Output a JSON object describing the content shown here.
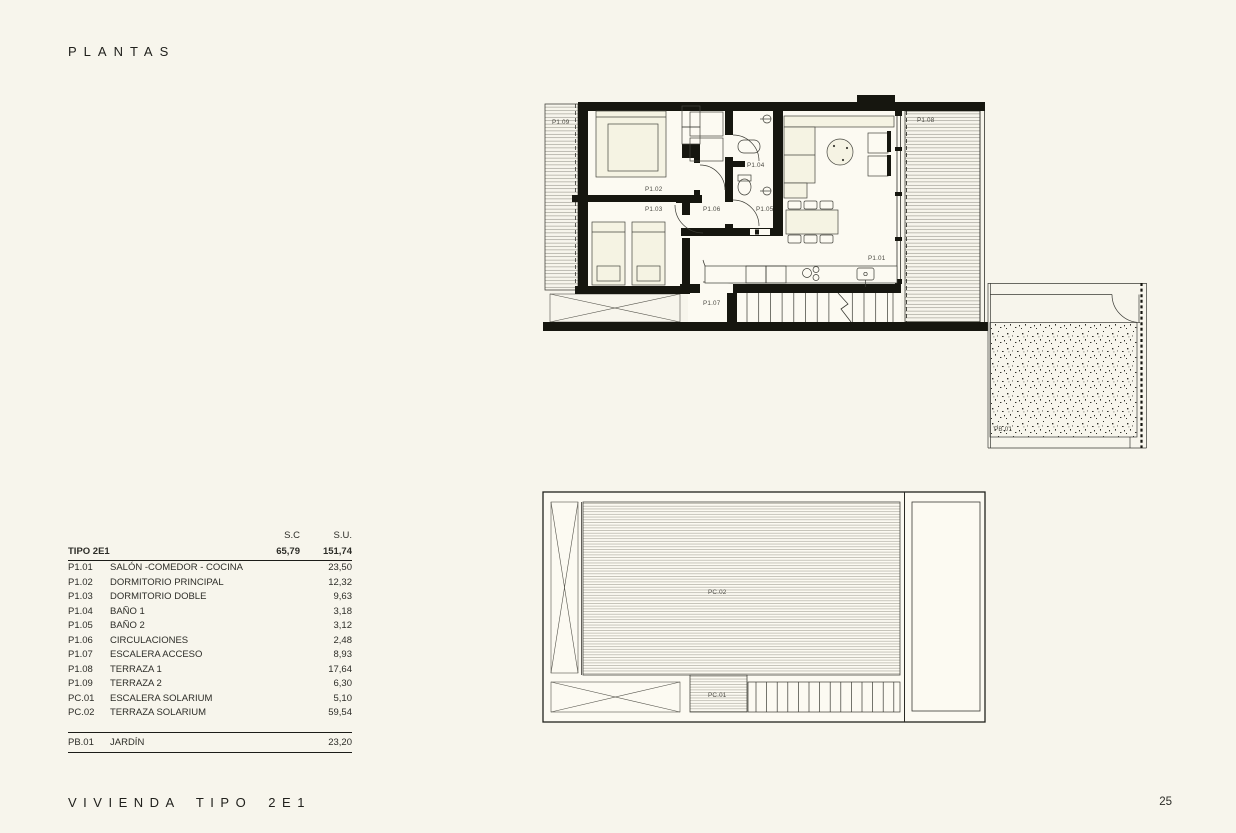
{
  "page": {
    "title": "PLANTAS",
    "footer": "VIVIENDA TIPO 2E1",
    "page_number": "25",
    "background_color": "#f7f5ec",
    "wall_color": "#16160f",
    "label_color": "#4c4b44"
  },
  "upper_plan": {
    "name": "planta-primera",
    "labels": {
      "p101": "P1.01",
      "p102": "P1.02",
      "p103": "P1.03",
      "p104": "P1.04",
      "p105": "P1.05",
      "p106": "P1.06",
      "p107": "P1.07",
      "p108": "P1.08",
      "p109": "P1.09",
      "pb01": "PB.01"
    }
  },
  "lower_plan": {
    "name": "planta-cubierta-solarium",
    "labels": {
      "pc01": "PC.01",
      "pc02": "PC.02"
    }
  },
  "table": {
    "col_headers": {
      "sc": "S.C",
      "su": "S.U."
    },
    "total": {
      "code": "TIPO 2E1",
      "sc": "65,79",
      "su": "151,74"
    },
    "rows": [
      {
        "code": "P1.01",
        "name": "SALÓN -COMEDOR - COCINA",
        "su": "23,50"
      },
      {
        "code": "P1.02",
        "name": "DORMITORIO PRINCIPAL",
        "su": "12,32"
      },
      {
        "code": "P1.03",
        "name": "DORMITORIO DOBLE",
        "su": "9,63"
      },
      {
        "code": "P1.04",
        "name": "BAÑO 1",
        "su": "3,18"
      },
      {
        "code": "P1.05",
        "name": "BAÑO 2",
        "su": "3,12"
      },
      {
        "code": "P1.06",
        "name": "CIRCULACIONES",
        "su": "2,48"
      },
      {
        "code": "P1.07",
        "name": "ESCALERA ACCESO",
        "su": "8,93"
      },
      {
        "code": "P1.08",
        "name": "TERRAZA 1",
        "su": "17,64"
      },
      {
        "code": "P1.09",
        "name": "TERRAZA 2",
        "su": "6,30"
      },
      {
        "code": "PC.01",
        "name": "ESCALERA SOLARIUM",
        "su": "5,10"
      },
      {
        "code": "PC.02",
        "name": "TERRAZA SOLARIUM",
        "su": "59,54"
      }
    ],
    "garden_row": {
      "code": "PB.01",
      "name": "JARDÍN",
      "su": "23,20"
    }
  }
}
